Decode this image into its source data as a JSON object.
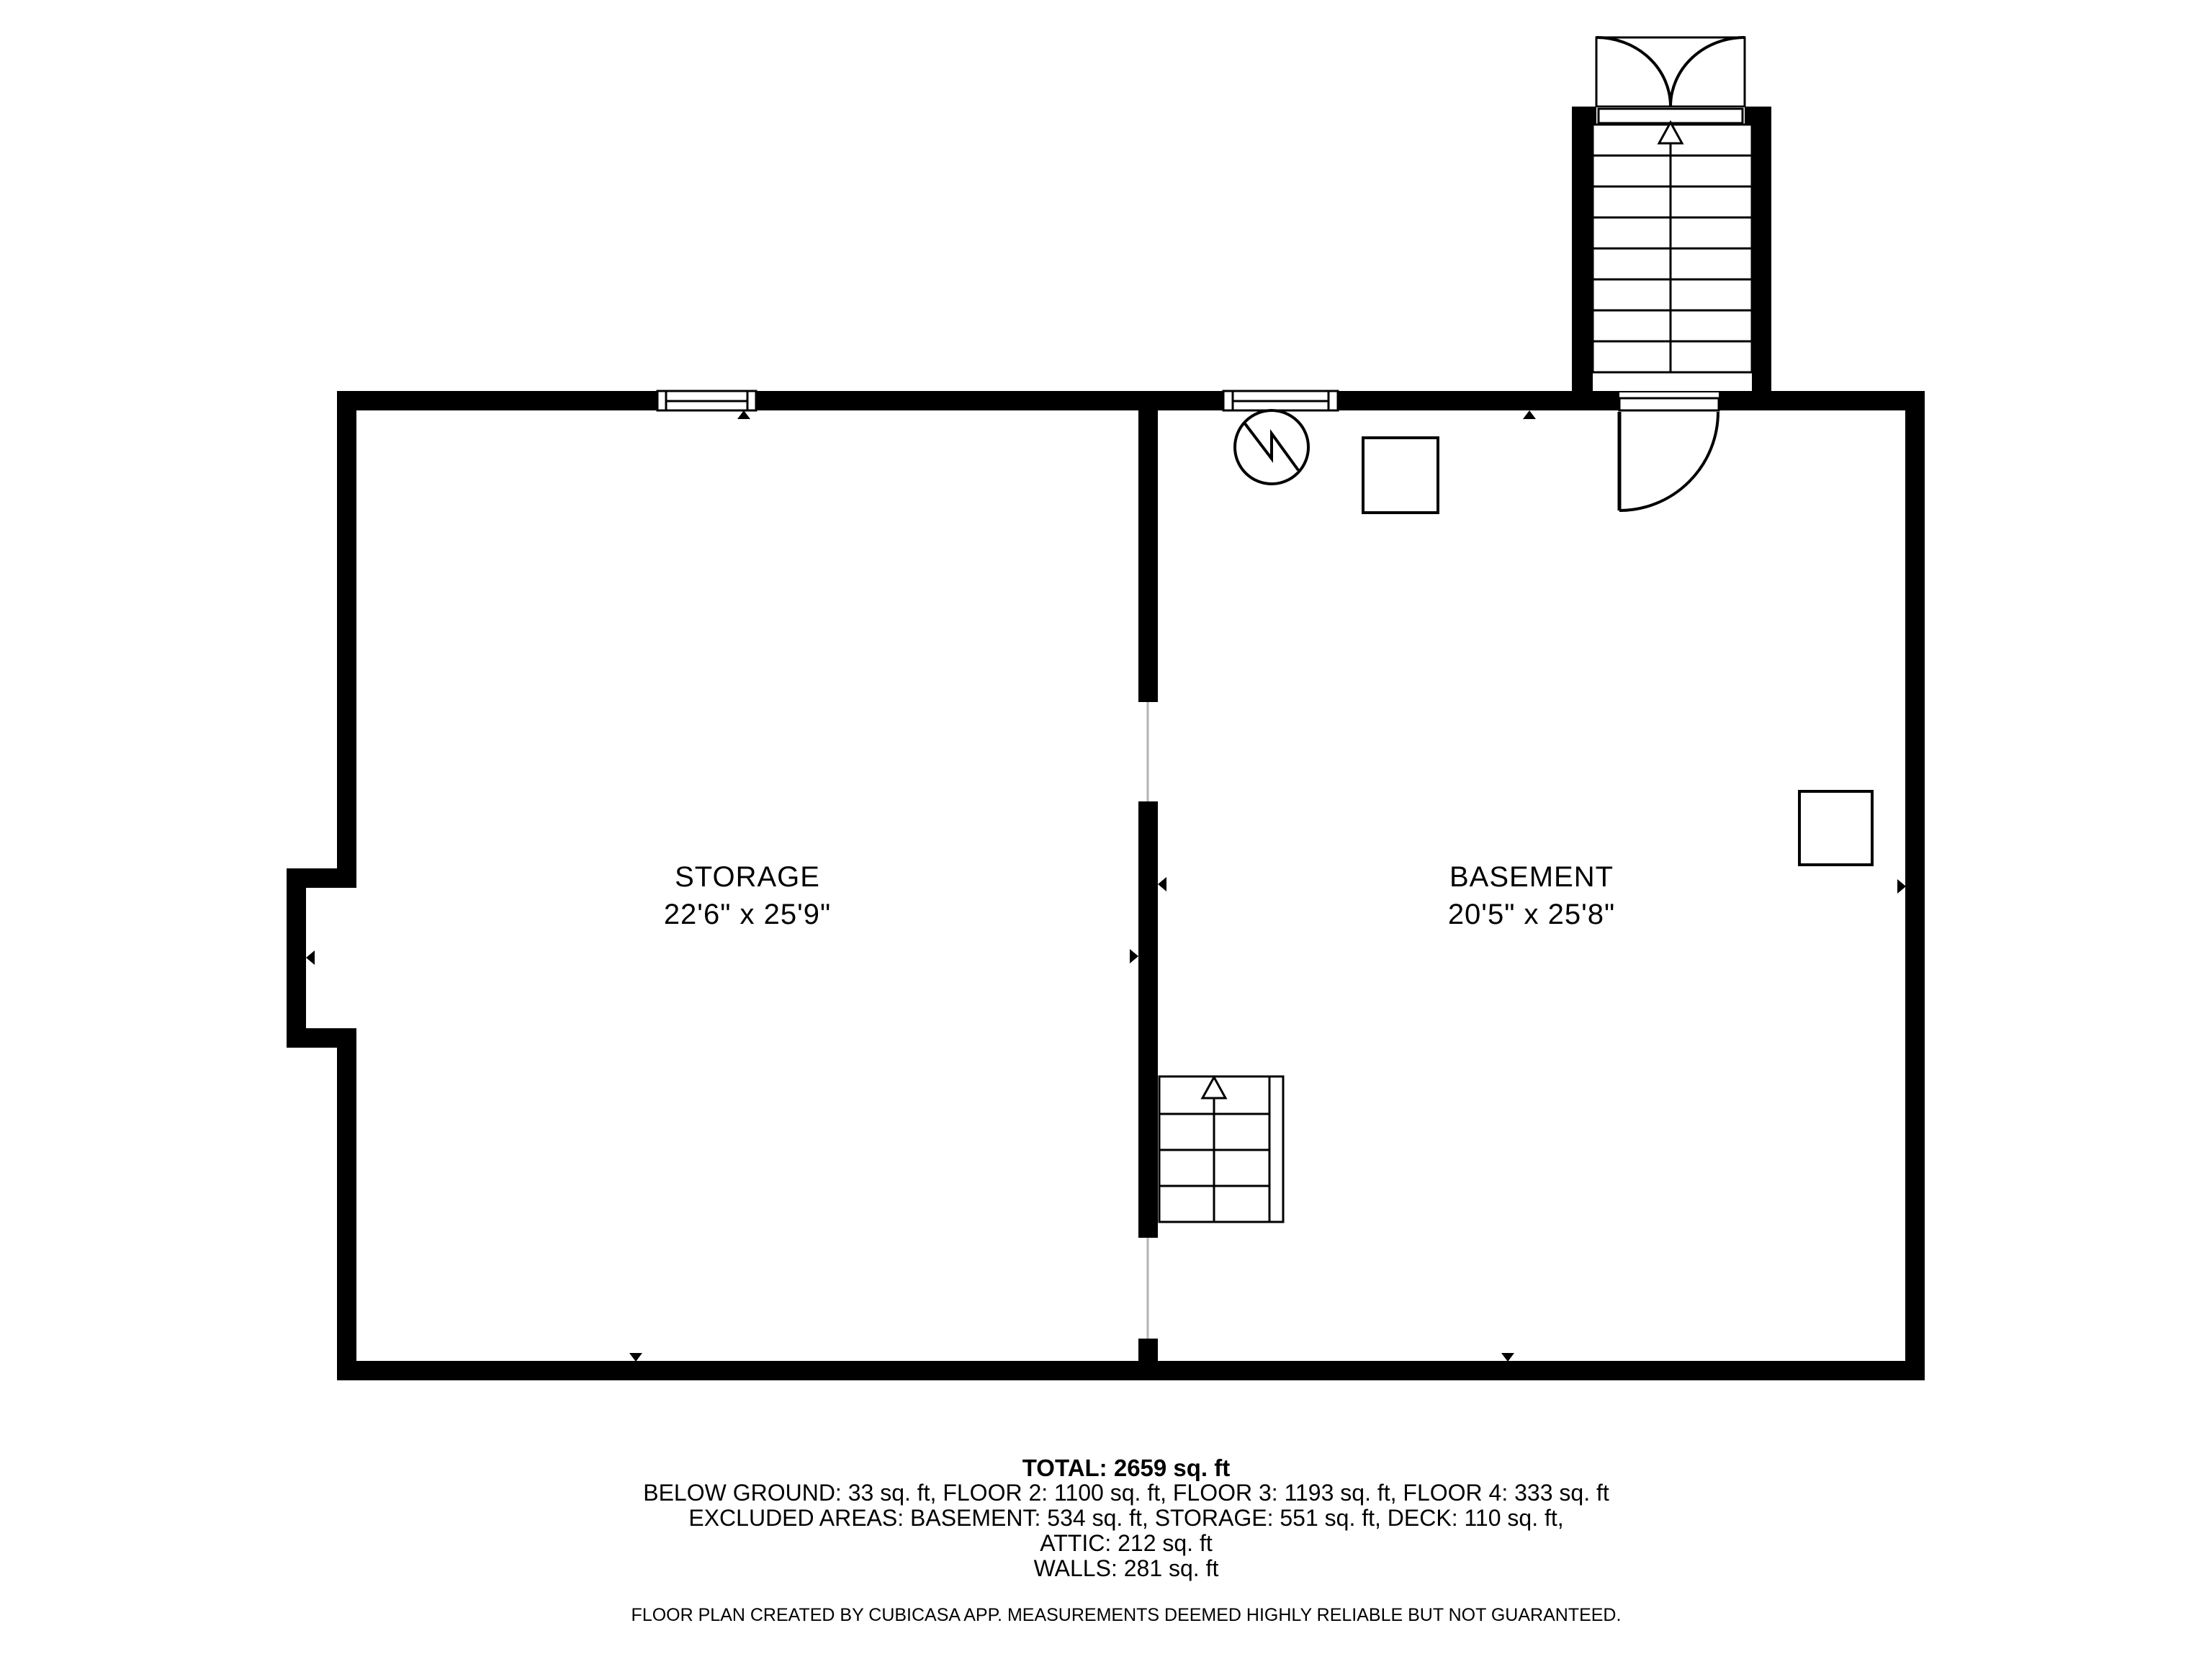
{
  "floorplan": {
    "rooms": [
      {
        "name": "STORAGE",
        "dimensions": "22'6\" x 25'9\""
      },
      {
        "name": "BASEMENT",
        "dimensions": "20'5\" x 25'8\""
      }
    ],
    "summary": {
      "total": "TOTAL: 2659 sq. ft",
      "lines": [
        "BELOW GROUND: 33 sq. ft, FLOOR 2: 1100 sq. ft, FLOOR 3: 1193 sq. ft, FLOOR 4: 333 sq. ft",
        "EXCLUDED AREAS: BASEMENT: 534 sq. ft, STORAGE: 551 sq. ft, DECK: 110 sq. ft,",
        "ATTIC: 212 sq. ft",
        "WALLS: 281 sq. ft"
      ]
    },
    "disclaimer": "FLOOR PLAN CREATED BY CUBICASA APP. MEASUREMENTS DEEMED HIGHLY RELIABLE BUT NOT GUARANTEED.",
    "colors": {
      "wall": "#000000",
      "background": "#ffffff",
      "opening_line": "#b3b3b3"
    }
  }
}
